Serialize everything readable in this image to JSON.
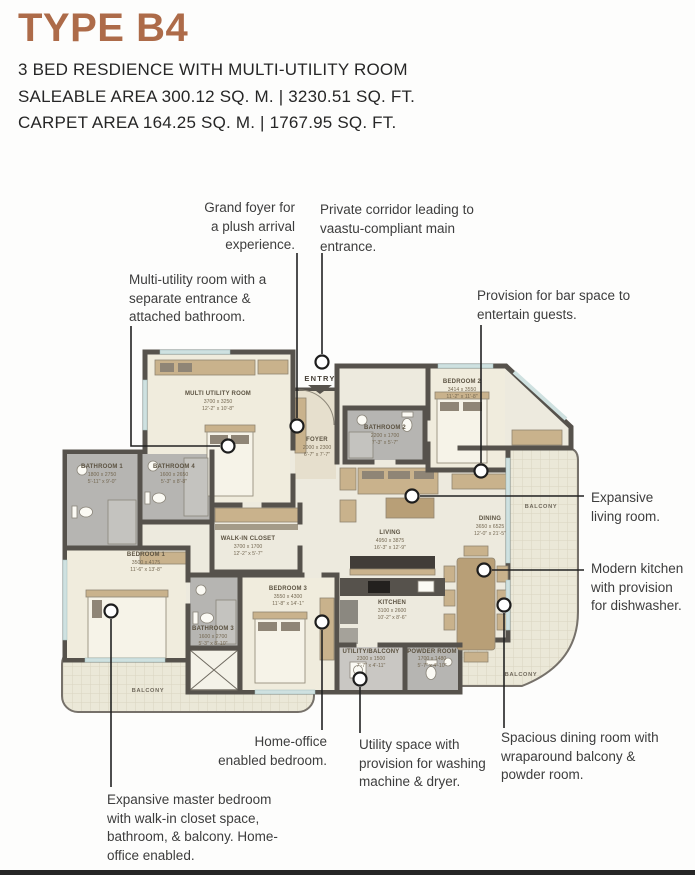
{
  "header": {
    "title": "TYPE B4",
    "line1": "3 BED RESDIENCE WITH MULTI-UTILITY ROOM",
    "line2": "SALEABLE AREA 300.12 SQ. M. | 3230.51 SQ. FT.",
    "line3": "CARPET AREA 164.25 SQ. M. | 1767.95 SQ. FT."
  },
  "callouts": {
    "grand_foyer": "Grand foyer for a plush arrival experience.",
    "private_corridor": "Private corridor leading to vaastu-compliant main entrance.",
    "multi_utility": "Multi-utility room with a separate entrance & attached bathroom.",
    "bar_space": "Provision for bar space to entertain guests.",
    "expansive_living": "Expansive living room.",
    "modern_kitchen": "Modern kitchen with provision for dishwasher.",
    "spacious_dining": "Spacious dining room with wraparound balcony & powder room.",
    "utility_space": "Utility space with provision for washing machine & dryer.",
    "home_office": "Home-office enabled bedroom.",
    "master_bedroom": "Expansive master bedroom with walk-in closet space, bathroom, & balcony. Home-office enabled."
  },
  "plan": {
    "entry_label": "ENTRY",
    "balcony_label": "BALCONY",
    "rooms": {
      "multi_utility": {
        "name": "MULTI UTILITY ROOM",
        "mm": "3700 x 3250",
        "ft": "12'-2\" x 10'-8\""
      },
      "foyer": {
        "name": "FOYER",
        "mm": "2000 x 2300",
        "ft": "6'-7\" x 7'-7\""
      },
      "bathroom2": {
        "name": "BATHROOM 2",
        "mm": "2200 x 1700",
        "ft": "7'-3\" x 5'-7\""
      },
      "bedroom2": {
        "name": "BEDROOM 2",
        "mm": "3414 x 3550",
        "ft": "11'-2\" x 11'-8\""
      },
      "bathroom1": {
        "name": "BATHROOM 1",
        "mm": "1800 x 2750",
        "ft": "5'-11\" x 9'-0\""
      },
      "bathroom4": {
        "name": "BATHROOM 4",
        "mm": "1600 x 2650",
        "ft": "5'-3\" x 8'-8\""
      },
      "walk_in_closet": {
        "name": "WALK-IN CLOSET",
        "mm": "3700 x 1700",
        "ft": "12'-2\" x 5'-7\""
      },
      "bedroom1": {
        "name": "BEDROOM 1",
        "mm": "3500 x 4175",
        "ft": "11'-6\" x 13'-8\""
      },
      "bedroom3": {
        "name": "BEDROOM 3",
        "mm": "3550 x 4300",
        "ft": "11'-8\" x 14'-1\""
      },
      "bathroom3": {
        "name": "BATHROOM 3",
        "mm": "1600 x 2700",
        "ft": "5'-3\" x 8'-10\""
      },
      "living": {
        "name": "LIVING",
        "mm": "4950 x 3875",
        "ft": "16'-3\" x 12'-9\""
      },
      "dining": {
        "name": "DINING",
        "mm": "3650 x 6525",
        "ft": "12'-0\" x 21'-5\""
      },
      "kitchen": {
        "name": "KITCHEN",
        "mm": "3100 x 2600",
        "ft": "10'-2\" x 8'-6\""
      },
      "utility": {
        "name": "UTILITY/BALCONY",
        "mm": "2300 x 1500",
        "ft": "7'-7\" x 4'-11\""
      },
      "powder": {
        "name": "POWDER ROOM",
        "mm": "1700 x 1480",
        "ft": "5'-7\" x 4'-10\""
      }
    }
  }
}
